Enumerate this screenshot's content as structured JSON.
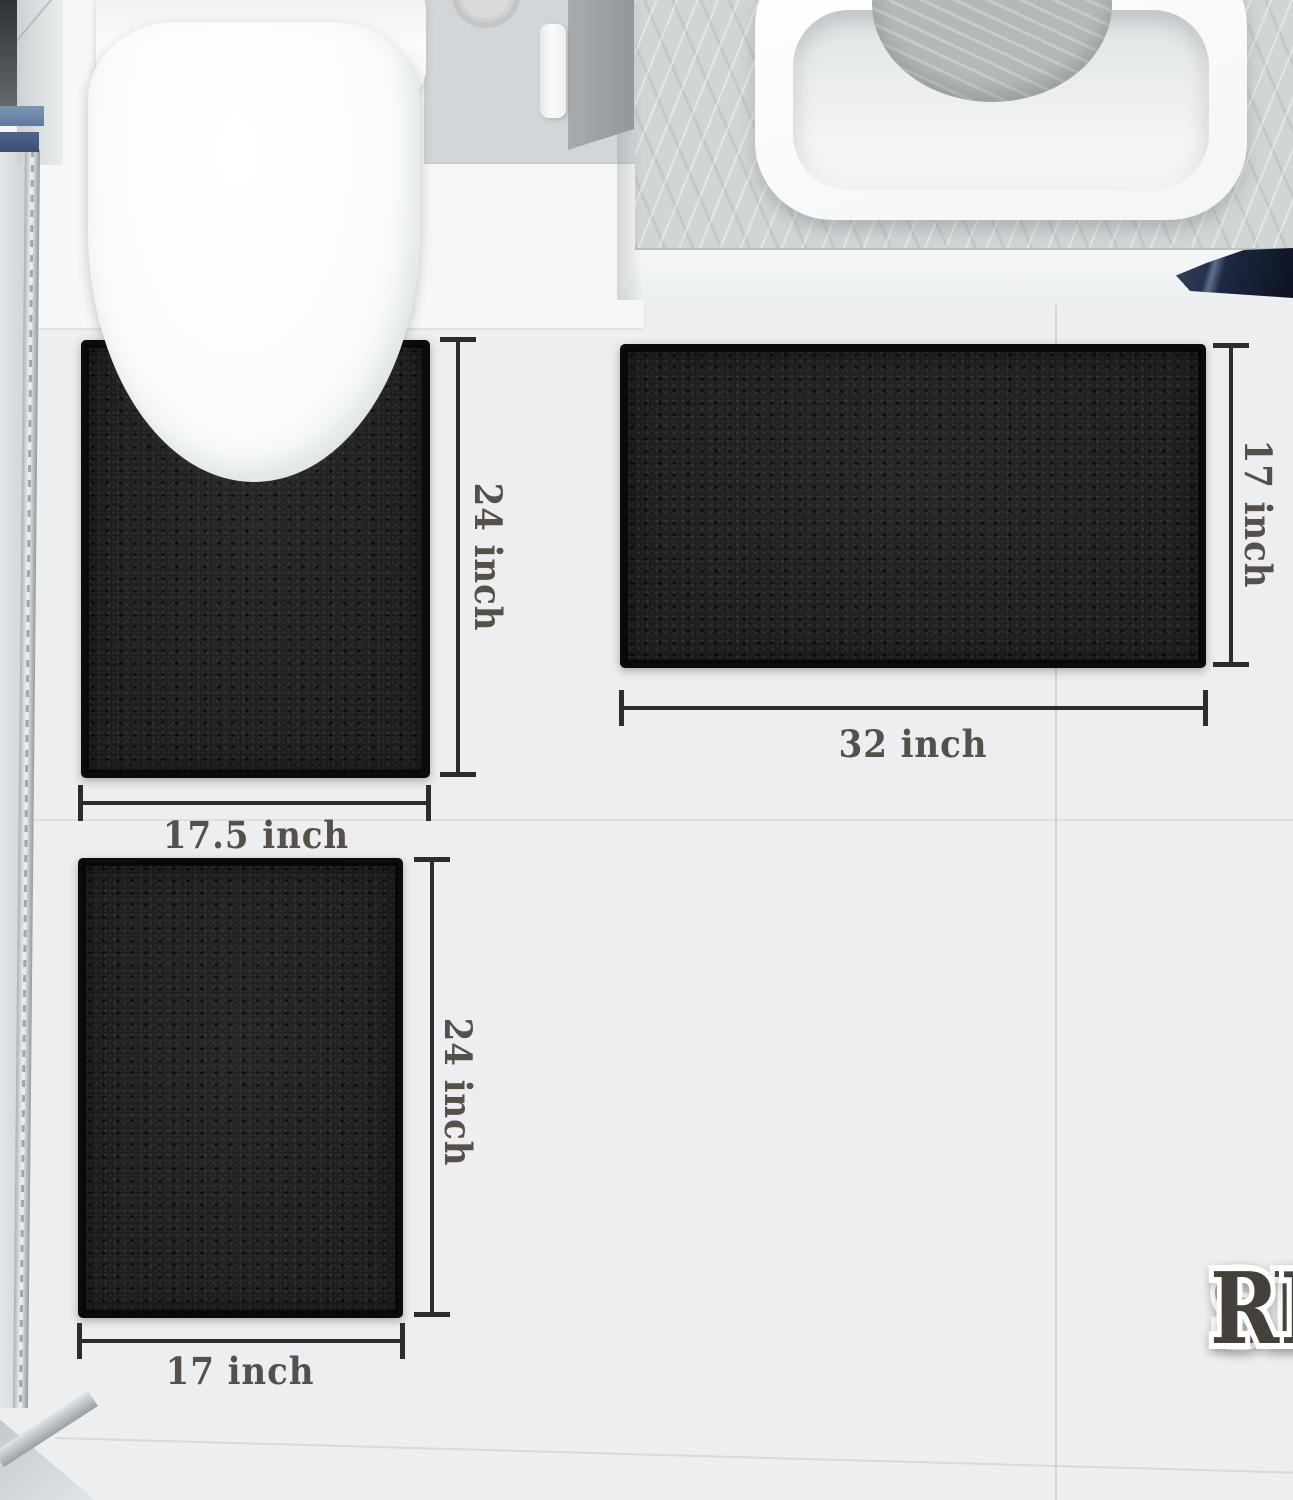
{
  "title": {
    "line1": "SIZE",
    "line2": "REFERENCE"
  },
  "dimensions": {
    "contour_rug": {
      "height": "24 inch",
      "width": "17.5 inch"
    },
    "large_rug": {
      "height": "17 inch",
      "width": "32 inch"
    },
    "small_rug": {
      "height": "24 inch",
      "width": "17 inch"
    }
  },
  "colors": {
    "rug": "#1d1d1d",
    "dimension_line": "#2c2c2c",
    "dimension_text": "#56504a",
    "title_text": "#46403a",
    "floor": "#eceeef",
    "towel_navy": "#1f2940",
    "hinge_blue": "#6e87ab"
  }
}
